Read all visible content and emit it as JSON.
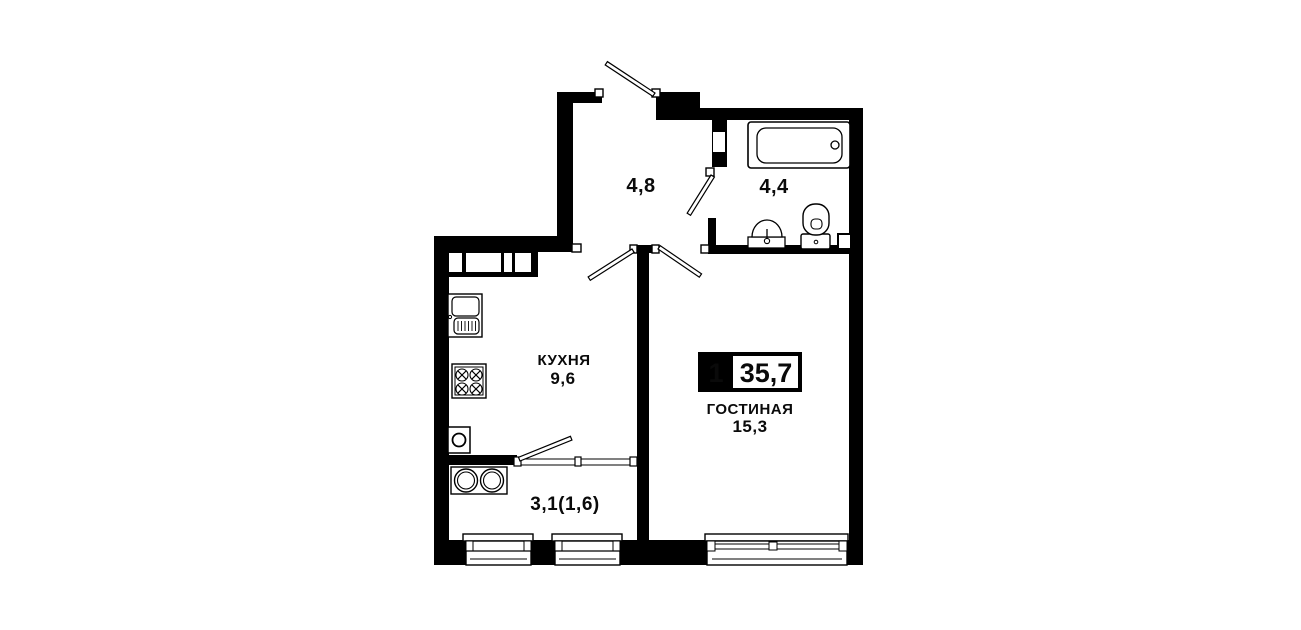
{
  "page": {
    "background_color": "#ffffff",
    "wall_color": "#000000"
  },
  "floorplan": {
    "badge": {
      "room_count": "1",
      "total_area": "35,7"
    },
    "hallway": {
      "area": "4,8"
    },
    "bathroom": {
      "area": "4,4"
    },
    "kitchen": {
      "name": "КУХНЯ",
      "area": "9,6"
    },
    "living_room": {
      "name": "ГОСТИНАЯ",
      "area": "15,3"
    },
    "balcony": {
      "area": "3,1(1,6)"
    }
  }
}
